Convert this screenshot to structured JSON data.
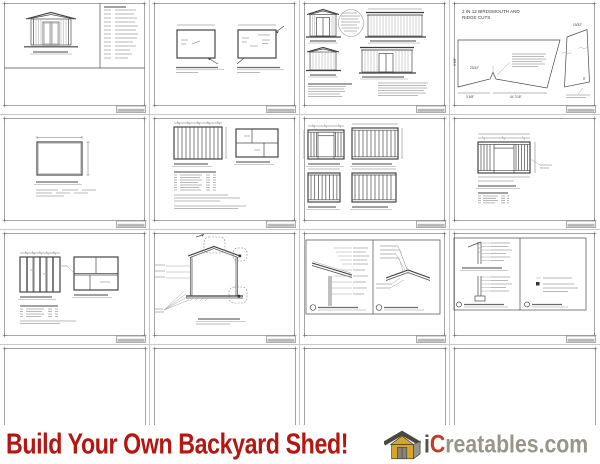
{
  "page": {
    "background": "#ffffff",
    "grid_line_color": "#c9c9c9",
    "description_note": "4x4 grid of shed blueprint page thumbnails with promo footer"
  },
  "sheets": {
    "birdsmouth": {
      "title_line1": "2 IN 12 BIRDSMOUTH AND",
      "title_line2": "RIDGE CUTS",
      "dim_top_right": "19/32\"",
      "dim_left": "3 5/8\"",
      "dim_notch": "23/32\"",
      "dim_bottom_left": "3 5/8\"",
      "dim_bottom_center": "44 7/16\"",
      "dim_right_piece": "5\""
    }
  },
  "footer": {
    "headline": "Build Your Own Backyard Shed!",
    "brand_i": "i",
    "brand_c": "C",
    "brand_rest": "reatables.com",
    "colors": {
      "headline": "#b41612",
      "brand_i": "#55524a",
      "brand_c": "#c13b27",
      "brand_rest": "#98958a",
      "logo_gold": "#d7a527",
      "logo_gray": "#96948a",
      "logo_roof": "#4a4940",
      "logo_door": "#8a8376"
    }
  }
}
